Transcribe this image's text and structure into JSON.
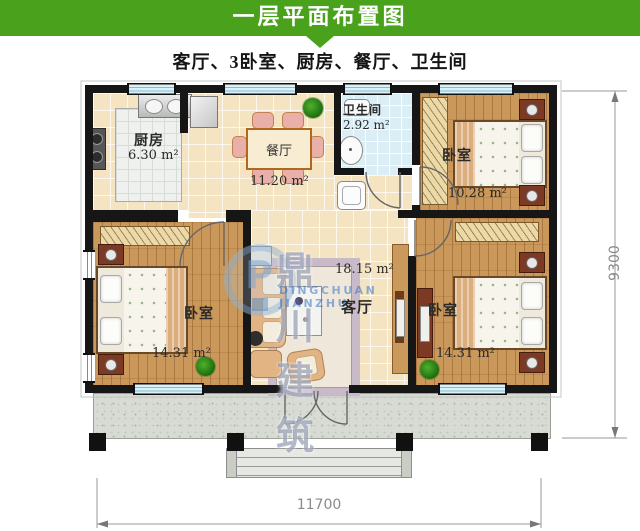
{
  "header": {
    "title": "一层平面布置图",
    "subtitle": "客厅、3卧室、厨房、餐厅、卫生间"
  },
  "rooms": {
    "kitchen": {
      "name": "厨房",
      "area": "6.30 m²"
    },
    "dining": {
      "name": "餐厅",
      "area": "11.20 m²"
    },
    "bathroom": {
      "name": "卫生间",
      "area": "2.92 m²"
    },
    "bedroom_top_right": {
      "name": "卧室",
      "area": "10.28 m²"
    },
    "bedroom_bottom_left": {
      "name": "卧室",
      "area": "14.31 m²"
    },
    "living_room": {
      "name": "客厅",
      "area": "18.15 m²"
    },
    "bedroom_bottom_right": {
      "name": "卧室",
      "area": "14.31 m²"
    }
  },
  "dimensions": {
    "overall_width_mm": "11700",
    "overall_depth_mm": "9300"
  },
  "watermark": {
    "logo_letter": "P",
    "company_cn": "鼎川建筑",
    "company_en": "DINGCHUAN JIANZHU"
  },
  "colors": {
    "header_green": "#4aa11c",
    "wall_black": "#161616",
    "wood_floor": "#c9985a",
    "tile_cream": "#f4e4c2",
    "bath_blue": "#dceef5"
  }
}
